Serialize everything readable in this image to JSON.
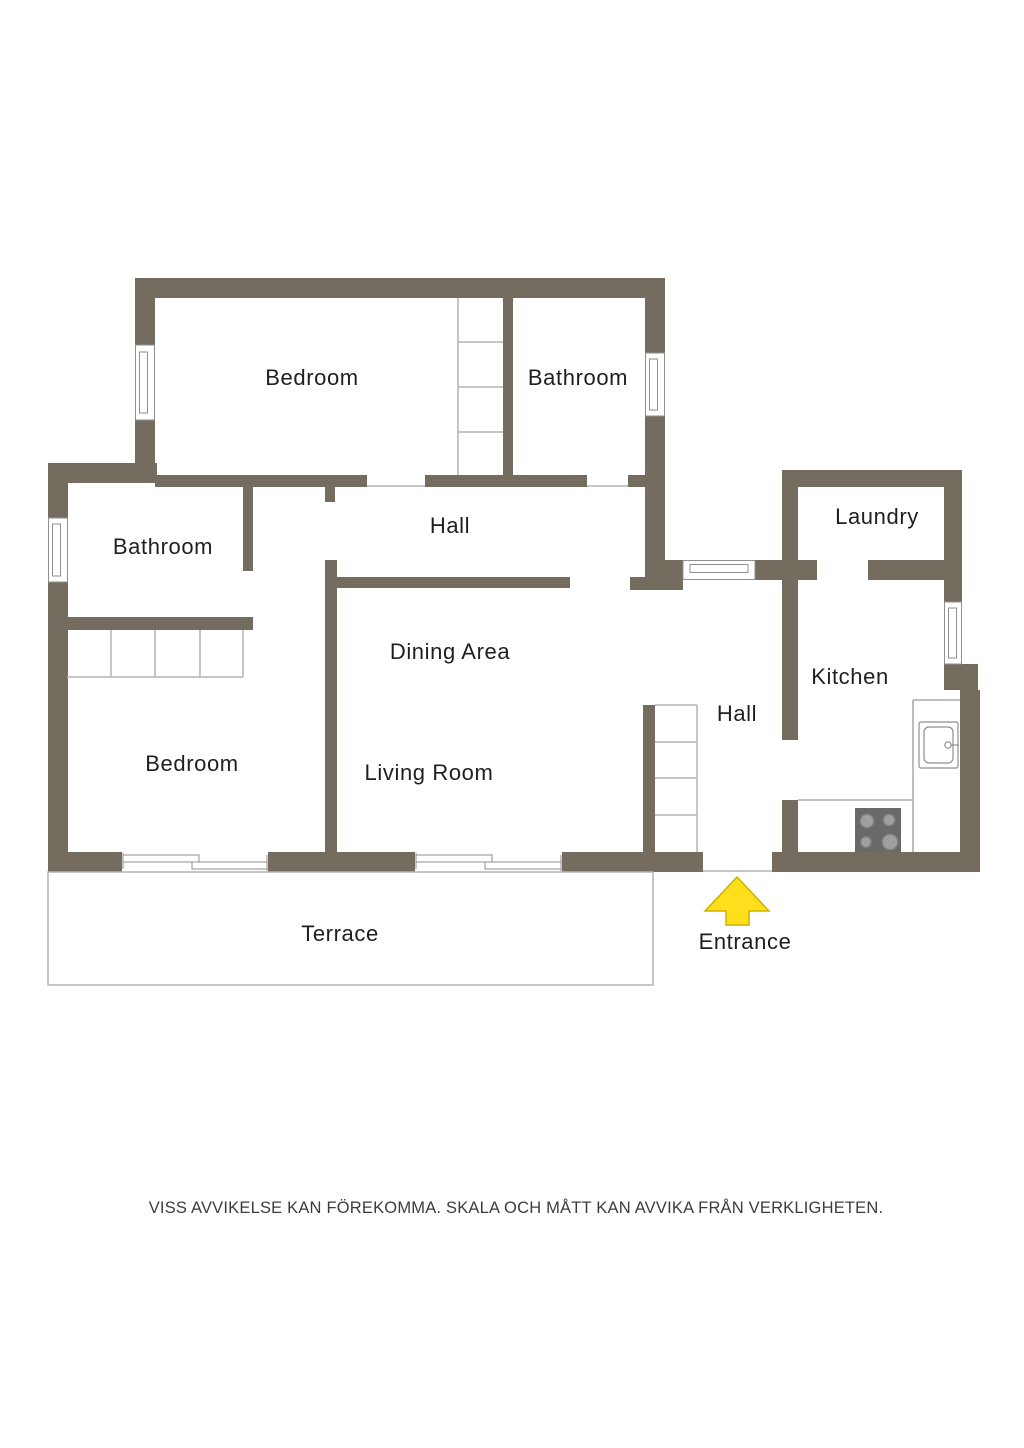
{
  "plan": {
    "rooms": {
      "bedroom_top": "Bedroom",
      "bathroom_top": "Bathroom",
      "hall_top": "Hall",
      "bathroom_left": "Bathroom",
      "laundry": "Laundry",
      "dining": "Dining Area",
      "kitchen": "Kitchen",
      "hall_right": "Hall",
      "bedroom_left": "Bedroom",
      "living": "Living Room",
      "terrace": "Terrace",
      "entrance": "Entrance"
    },
    "disclaimer": "VISS AVVIKELSE KAN FÖREKOMMA. SKALA OCH MÅTT KAN AVVIKA FRÅN VERKLIGHETEN.",
    "colors": {
      "wall": "#746c5f",
      "boundary_line": "#b3b3b3",
      "fixture_line": "#8f8f8f",
      "counter_line": "#9a9a9a",
      "stove_body": "#696969",
      "stove_burner": "#a0a0a0",
      "stove_burner_ring": "#7a7a7a",
      "arrow": "#ffdf1b",
      "arrow_outline": "#c9b400",
      "label_text": "#1f1f1f",
      "disclaimer_text": "#3c3c3c"
    }
  }
}
